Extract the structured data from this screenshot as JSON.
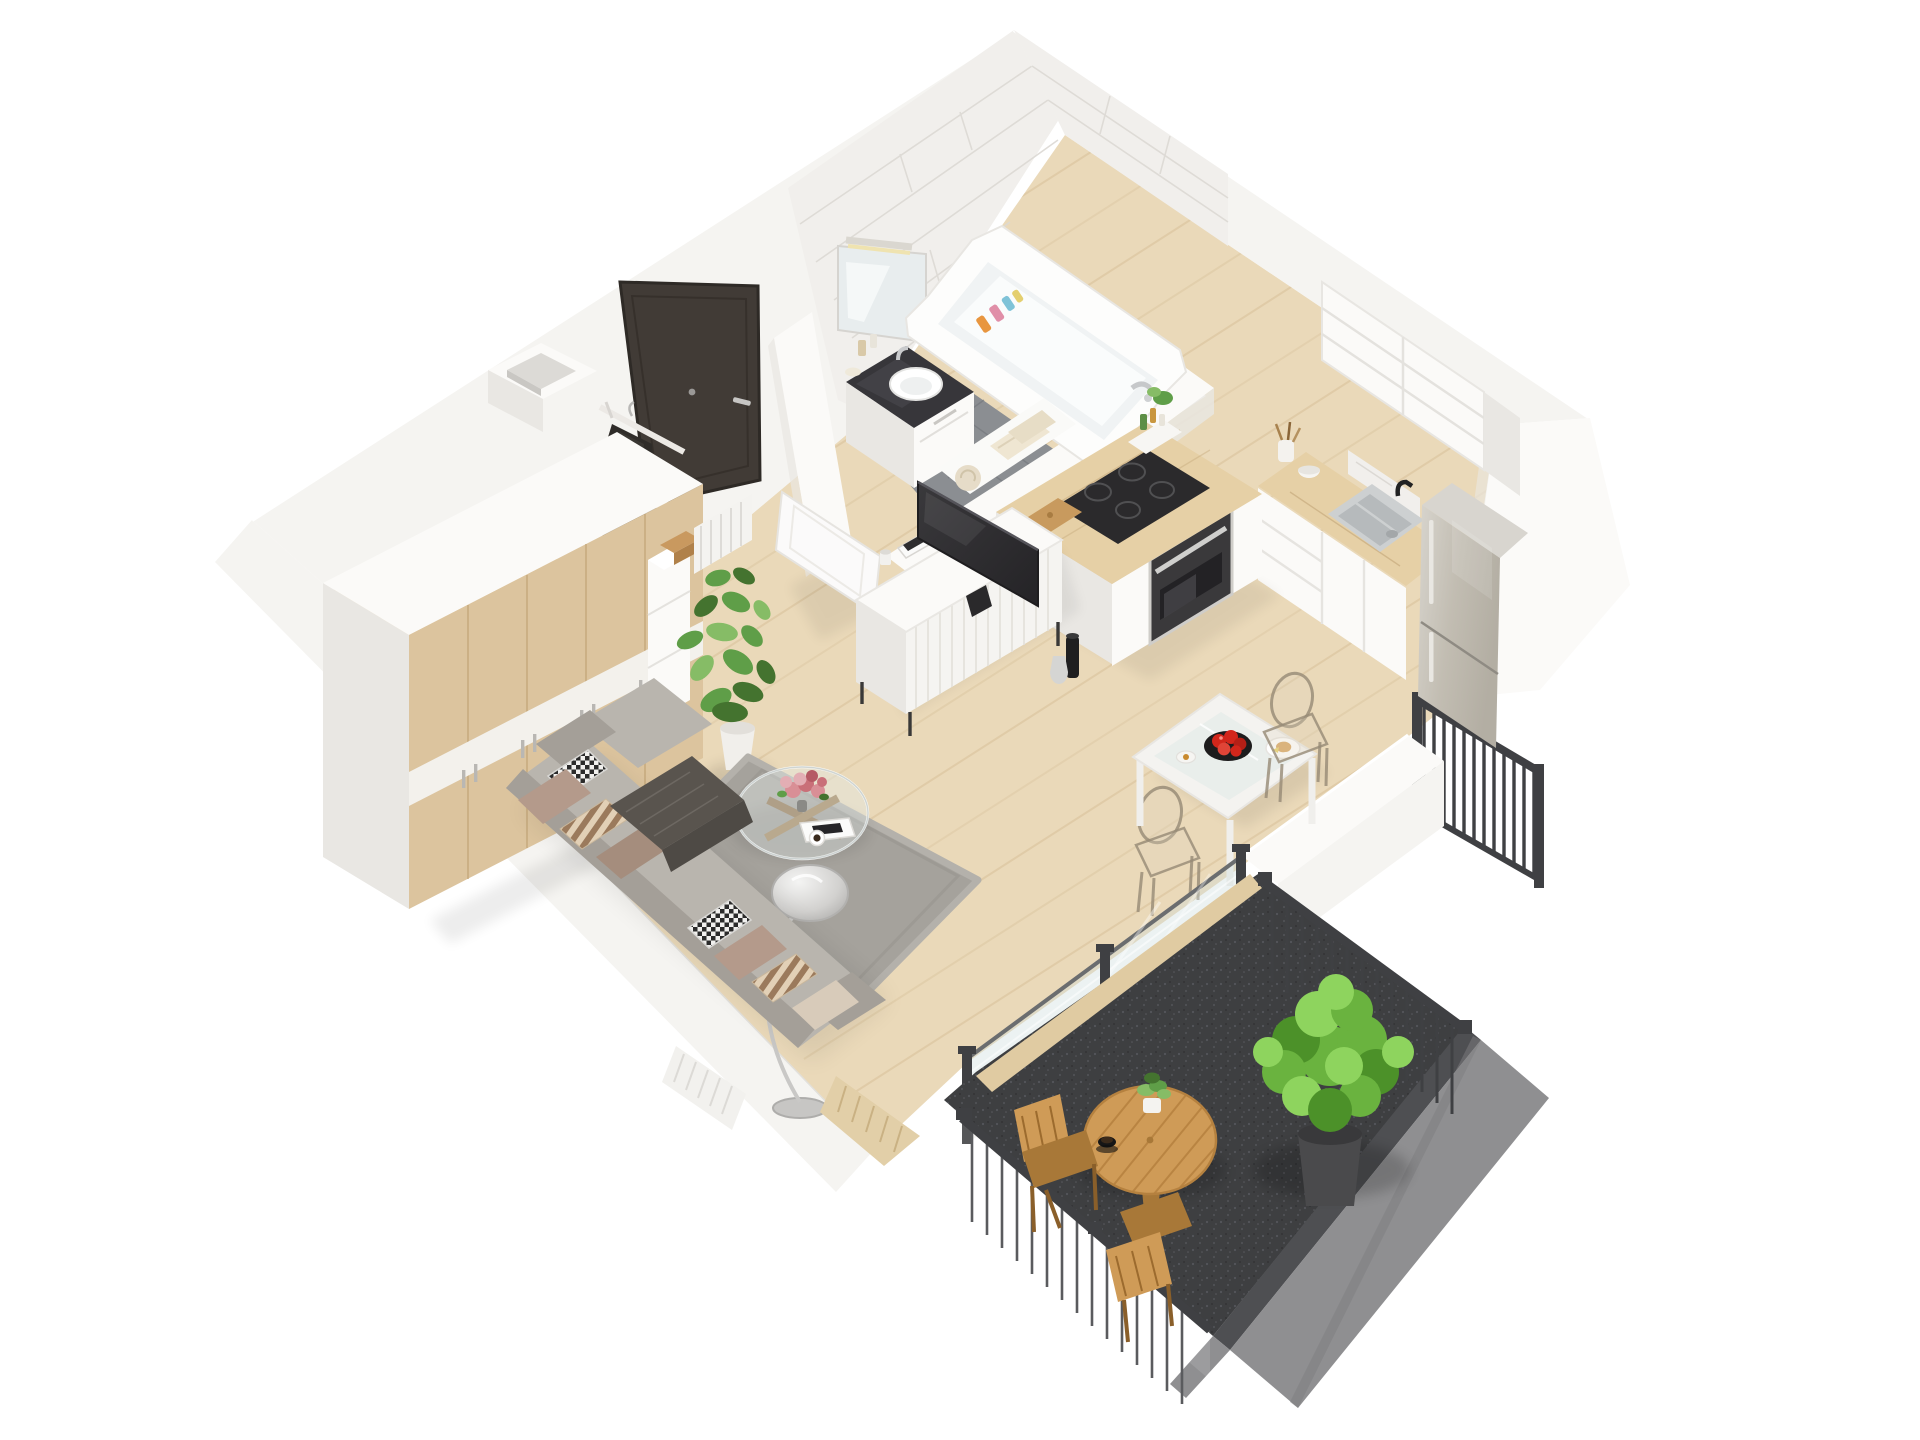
{
  "meta": {
    "kind": "3d-floor-plan-render",
    "view": "isometric top-down cutaway",
    "subject": "studio apartment with balcony",
    "visible_text": ""
  },
  "palette": {
    "wall": "#f5f4f1",
    "wallShade": "#e9e7e3",
    "softWhite": "#fbfaf8",
    "tile": "#f1efec",
    "tileLine": "#dcd9d4",
    "floorWood": "#ead9b9",
    "floorWoodLine": "#d5bd96",
    "bathFloor": "#8b8e92",
    "bathFloorLine": "#73767b",
    "balconyFloor": "#3e3f41",
    "parapet": "#8f8f91",
    "parapetDark": "#4e4f52",
    "railDark": "#3f4043",
    "doorDark": "#413b36",
    "oak": "#dcc49e",
    "oakLine": "#c3a678",
    "counterWood": "#e6d0a6",
    "rug": "#a5a29c",
    "rugDark": "#8f8c86",
    "sofa": "#b9b5ae",
    "sofaDark": "#a49f98",
    "tvDark": "#2d2c2e",
    "steel": "#c9c5bd",
    "pillowBeige": "#b49a8b",
    "pillowTaupe": "#a58d7d",
    "pillowCream": "#d8cbBa",
    "throwDark": "#59544e",
    "plantGreen": "#5f9e48",
    "plantLight": "#86bc66",
    "plantDark": "#44732f",
    "bushGreen": "#6ab33f",
    "bushLight": "#8ed45e",
    "bushDark": "#4c9129",
    "outdoorWood": "#cf9b57",
    "outdoorWoodDark": "#a87838",
    "accentRed": "#d2261b",
    "accentPink": "#d98f96",
    "glassFill": "rgba(205,220,222,0.38)",
    "glassEdge": "#6b6d6f"
  },
  "rooms": [
    {
      "name": "entry-hall",
      "items": [
        "entrance-door",
        "door-handle",
        "peephole",
        "coat-rack",
        "hanging-coat",
        "shoe-cabinet",
        "cardboard-box",
        "ventilation-column",
        "hall-radiator"
      ]
    },
    {
      "name": "bathroom",
      "items": [
        "marble-wall-tiles",
        "mirror",
        "mirror-light",
        "vanity-counter",
        "wash-basin",
        "vanity-drawers",
        "cosmetic-bottles",
        "bathtub",
        "bath-faucet",
        "shampoo-bottles",
        "towels",
        "gray-tile-floor",
        "partition-wall",
        "open-white-door"
      ]
    },
    {
      "name": "kitchen",
      "items": [
        "island-counter",
        "induction-cooktop",
        "built-in-oven",
        "cutting-board",
        "spice-rack",
        "wall-cabinets",
        "marble-backsplash",
        "counter-sink",
        "black-faucet",
        "utensil-crock",
        "mortar",
        "fridge-freezer"
      ]
    },
    {
      "name": "living-room",
      "items": [
        "oak-wardrobe",
        "potted-plant",
        "tv",
        "tv-console",
        "magazines",
        "mug",
        "floor-vase",
        "sofa",
        "pillows",
        "throw-blanket",
        "shaggy-rug",
        "glass-coffee-table",
        "flower-bouquet",
        "coffee-cup",
        "magazine",
        "arc-floor-lamp",
        "radiator"
      ]
    },
    {
      "name": "dining-nook",
      "items": [
        "glass-dining-table",
        "ghost-chair-1",
        "ghost-chair-2",
        "fruit-bowl",
        "breakfast-plate",
        "candle",
        "partition-wall"
      ]
    },
    {
      "name": "balcony",
      "items": [
        "glass-sliding-wall",
        "wood-threshold",
        "anthracite-floor",
        "metal-railing-sw",
        "metal-railing-ne",
        "gray-parapet",
        "round-wood-table",
        "table-plant",
        "espresso-cup",
        "folding-chair-1",
        "folding-chair-2",
        "bush-in-planter",
        "juliet-railing"
      ]
    }
  ]
}
